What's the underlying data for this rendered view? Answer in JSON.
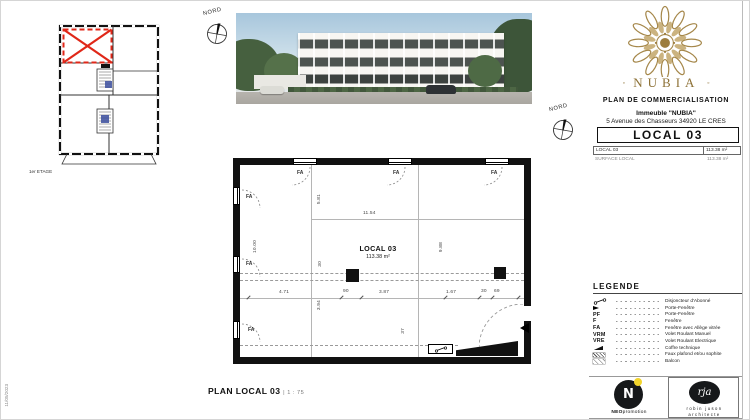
{
  "page": {
    "date": "11/05/2023"
  },
  "compass": {
    "label": "NORD"
  },
  "key_plan": {
    "floor_label": "1er ETAGE"
  },
  "title_block": {
    "brand": "NUBIA",
    "brand_dot": "◦",
    "doc_title": "PLAN DE COMMERCIALISATION",
    "building_line": "Immeuble \"NUBIA\"",
    "address_line": "5 Avenue des Chasseurs 34920 LE CRES",
    "local_title": "LOCAL 03",
    "info_rows": [
      {
        "label": "LOCAL 03",
        "value": "113.38 m²"
      },
      {
        "label": "SURFACE LOCAL",
        "value": "113.38 m²"
      }
    ]
  },
  "plan": {
    "room_label": "LOCAL 03",
    "room_area": "113.38 m²",
    "window_label": "FA",
    "dims": {
      "top": "11.54",
      "left": "10.00",
      "right": "9.88",
      "upper_vertical": "5.81",
      "lower_vertical": "3.94",
      "band": "30",
      "band_bottom": "37",
      "chain": [
        "4.71",
        "90",
        "3.87",
        "1.67",
        "30",
        "69"
      ]
    }
  },
  "legend": {
    "title": "LEGENDE",
    "items": [
      {
        "symbol": "disjoncteur-icon",
        "label": "Disjoncteur d'Abonné"
      },
      {
        "symbol": "porte-fenetre-triangle-icon",
        "label": "Porte-Fenêtre"
      },
      {
        "symbol_text": "PF",
        "label": "Porte-Fenêtre"
      },
      {
        "symbol_text": "F",
        "label": "Fenêtre"
      },
      {
        "symbol_text": "FA",
        "label": "Fenêtre avec Allège vitrée"
      },
      {
        "symbol_text": "VRM",
        "label": "Volet Roulant Manuel"
      },
      {
        "symbol_text": "VRE",
        "label": "Volet Roulant Electrique"
      },
      {
        "symbol": "coffre-icon",
        "label": "Coffre technique"
      },
      {
        "symbol": "hatch-dense-icon",
        "label": "Faux plafond et/ou sophite"
      },
      {
        "symbol": "hatch-light-icon",
        "label": "Balcon"
      }
    ]
  },
  "footer": {
    "plan_title": "PLAN LOCAL 03",
    "divider": "|",
    "scale": "1 : 75"
  },
  "logos": {
    "neo": {
      "monogram": "N",
      "name_bold": "NEO",
      "name_rest": "promotion"
    },
    "rja": {
      "monogram": "rja",
      "line1": "robin juson",
      "line2": "architecte"
    }
  }
}
